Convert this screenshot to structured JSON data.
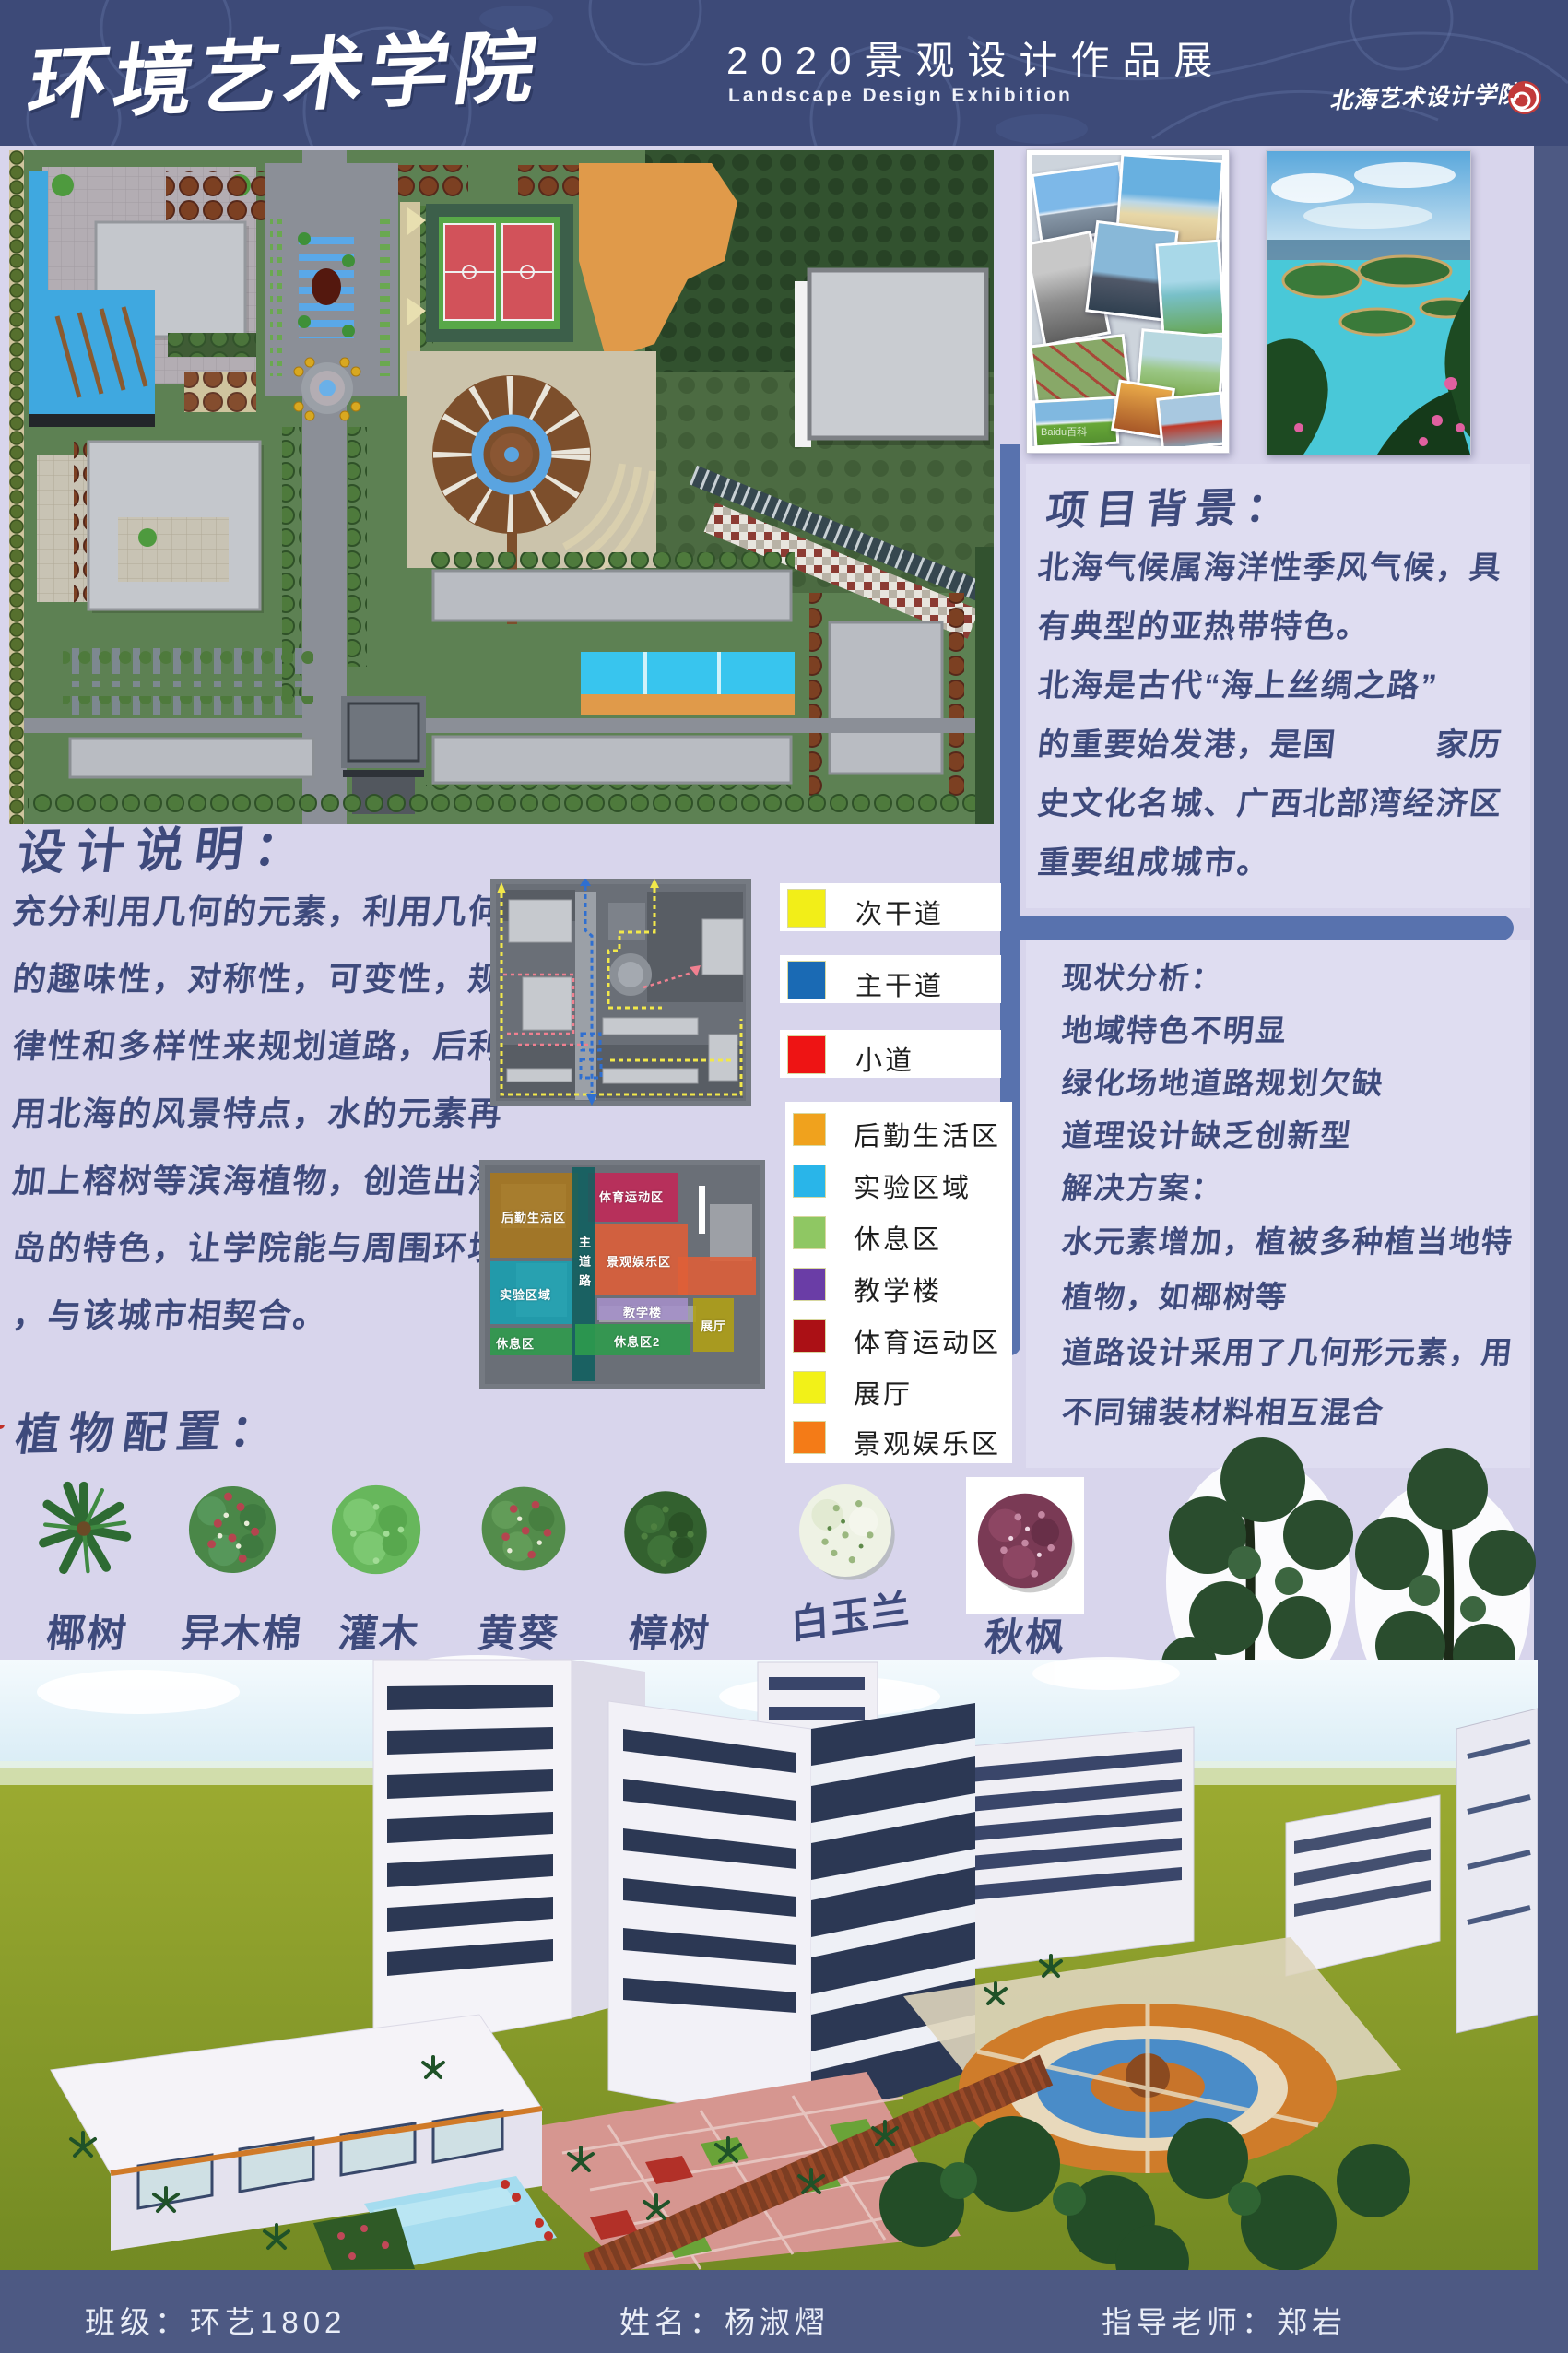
{
  "header": {
    "title": "环境艺术学院",
    "subtitle_cn": "2020景观设计作品展",
    "subtitle_en": "Landscape Design Exhibition",
    "school_name": "北海艺术设计学院"
  },
  "project_background": {
    "title": "项目背景：",
    "lines": [
      "北海气候属海洋性季风气候，具",
      "有典型的亚热带特色。",
      "北海是古代“海上丝绸之路”",
      "的重要始发港，是国　　　家历",
      "史文化名城、广西北部湾经济区",
      "重要组成城市。"
    ]
  },
  "design_description": {
    "title": "设计说明：",
    "lines": [
      "充分利用几何的元素，利用几何",
      "的趣味性，对称性，可变性，规",
      "律性和多样性来规划道路，后利",
      "用北海的风景特点，水的元素再",
      "加上榕树等滨海植物，创造出海",
      "岛的特色，让学院能与周围环境",
      "，与该城市相契合。"
    ]
  },
  "status_analysis": {
    "lines": [
      "现状分析：",
      "地域特色不明显",
      "绿化场地道路规划欠缺",
      "道理设计缺乏创新型",
      "解决方案：",
      "水元素增加，植被多种植当地特",
      "植物，如椰树等",
      "道路设计采用了几何形元素，用",
      "不同铺装材料相互混合"
    ]
  },
  "legend": {
    "roads": [
      {
        "label": "次干道",
        "color": "#f2ee18"
      },
      {
        "label": "主干道",
        "color": "#1a6ab4"
      },
      {
        "label": "小道",
        "color": "#ee1414"
      }
    ],
    "zones": [
      {
        "label": "后勤生活区",
        "color": "#f0a21d"
      },
      {
        "label": "实验区域",
        "color": "#29b5e9"
      },
      {
        "label": "休息区",
        "color": "#8fc763"
      },
      {
        "label": "教学楼",
        "color": "#6a3da6"
      },
      {
        "label": "体育运动区",
        "color": "#ab1015"
      },
      {
        "label": "展厅",
        "color": "#f2f118"
      },
      {
        "label": "景观娱乐区",
        "color": "#f47b17"
      }
    ]
  },
  "zoning_map": {
    "logistics": "后勤生活区",
    "sports": "体育运动区",
    "scenic": "景观娱乐区",
    "lab": "实验区域",
    "main_road": "主道路",
    "teaching": "教学楼",
    "exhibition": "展厅",
    "rest1": "休息区",
    "rest2": "休息区2"
  },
  "plants": {
    "title": "植物配置：",
    "items": [
      {
        "name": "椰树"
      },
      {
        "name": "异木棉"
      },
      {
        "name": "灌木"
      },
      {
        "name": "黄葵"
      },
      {
        "name": "樟树"
      },
      {
        "name": "白玉兰"
      },
      {
        "name": "秋枫"
      }
    ]
  },
  "photos": {
    "watermark": "Baidu百科"
  },
  "footer": {
    "class_label": "班级：环艺1802",
    "name_label": "姓名：杨淑熠",
    "teacher_label": "指导老师：郑岩"
  }
}
